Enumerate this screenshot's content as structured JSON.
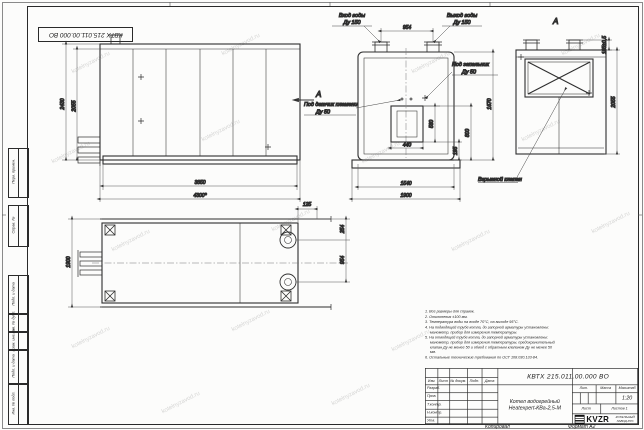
{
  "sheet": {
    "stamp_doc_number": "КВТХ 215.011.00.000 ВО",
    "copied_label": "Копировал",
    "format_label": "Формат А2"
  },
  "watermark": {
    "text": "kotelnyzavod.ru"
  },
  "margin_stamps": {
    "perv_primen": "Перв. примен.",
    "sprav_no": "Справ. №",
    "podp_data1": "Подп. и дата",
    "inv_dubl": "Инв. № дубл.",
    "vzam_inv": "Взам. инв. №",
    "podp_data2": "Подп. и дата",
    "inv_podl": "Инв. № подл."
  },
  "views": {
    "labels": {
      "water_inlet_1": "Вход воды",
      "water_inlet_2": "Ду 150",
      "water_outlet_1": "Выход воды",
      "water_outlet_2": "Ду 150",
      "igniter_1": "Под запальник",
      "igniter_2": "Ду 50",
      "flame_sensor_1": "Под датчик пламени",
      "flame_sensor_2": "Ду 50",
      "explosion_valve": "Взрывной клапан",
      "view_a": "А"
    },
    "dims": {
      "side_height_overall": "2430",
      "side_height_body": "2055",
      "side_length_body": "3850",
      "side_length_overall": "4300*",
      "flange_span": "954",
      "opening_height": "560",
      "opening_width": "440",
      "base_height": "195",
      "opening_elevation": "800",
      "front_height": "1670",
      "front_width_body": "1540",
      "front_width_overall": "1900",
      "rear_flange_offset": "185±0,5",
      "rear_height": "2055",
      "plan_width": "1900",
      "plan_offset": "125",
      "plan_edge_to_flange": "254",
      "plan_flange_span": "954"
    }
  },
  "notes": {
    "items": [
      "1. Все размеры для справок.",
      "2. Отклонения ±100 мм.",
      "3. Температура воды на входе 70°С, на выходе 95°С.",
      "4. На подводящей трубе котла, до запорной арматуры установлены: манометр, прибор для измерения температуры.",
      "5. На отводящей трубе котла, до запорной арматуры установлены: манометр, прибор для измерения температуры, предохранительный клапан Ду не менее 50 и обвод с обратным клапаном Ду не менее 50 мм.",
      "6. Остальные технические требования по ОСТ 108.030.133-84."
    ]
  },
  "title_block": {
    "doc_number": "КВТХ 215.011.00.000 ВО",
    "product_name_1": "Котел водогрейный",
    "product_name_2": "Heatexpert-КВа-2,5-М",
    "col_izm": "Изм.",
    "col_list": "Лист",
    "col_doc": "№ докум.",
    "col_podp": "Подп.",
    "col_data": "Дата",
    "row_razrab": "Разраб.",
    "row_prov": "Пров.",
    "row_tkontr": "Т.контр.",
    "row_nkontr": "Н.контр.",
    "row_utv": "Утв.",
    "lit": "Лит.",
    "massa": "Масса",
    "masshtab": "Масштаб",
    "scale": "1:20",
    "list": "Лист",
    "listov": "Листов  1",
    "logo": "KVZR",
    "company_1": "КОТЕЛЬНЫЙ",
    "company_2": "ЗАВОД.РУС"
  }
}
